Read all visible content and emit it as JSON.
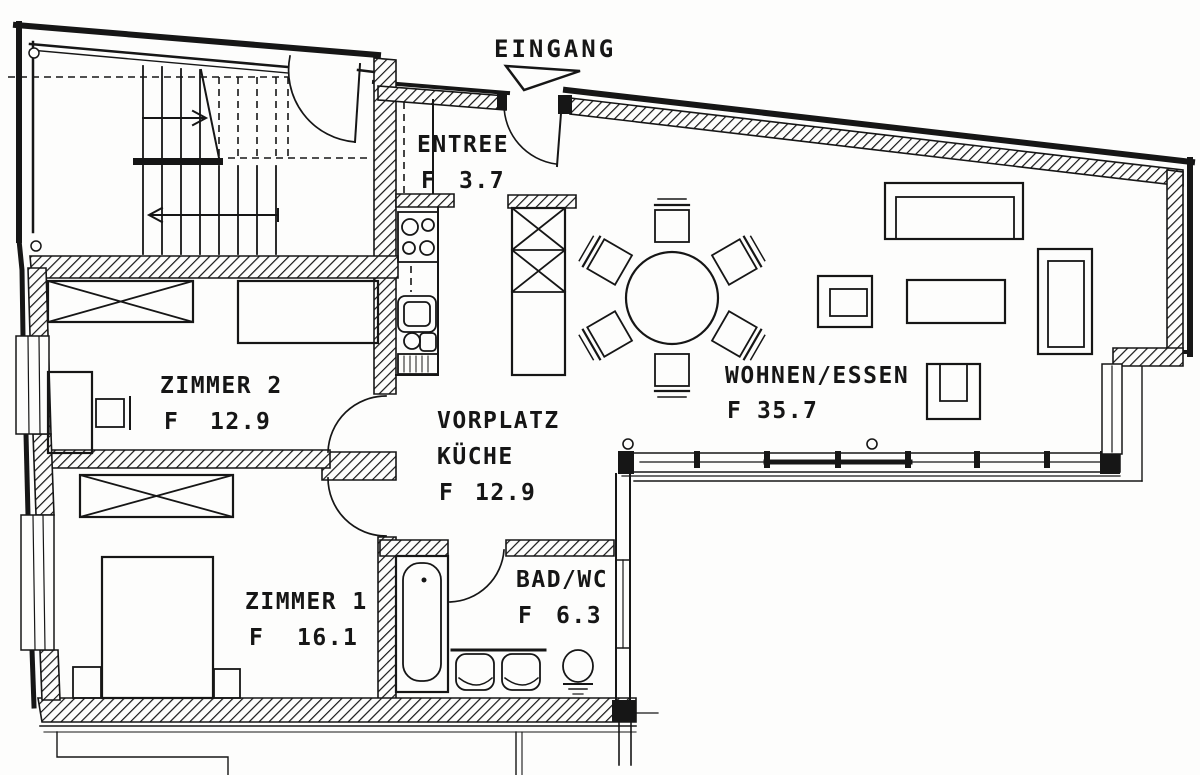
{
  "plan": {
    "entrance_label": "EINGANG",
    "rooms": {
      "entree": {
        "name": "ENTREE",
        "area_prefix": "F",
        "area": "3.7"
      },
      "vorplatz_kueche": {
        "name_line1": "VORPLATZ",
        "name_line2": "KÜCHE",
        "area_prefix": "F",
        "area": "12.9"
      },
      "zimmer2": {
        "name": "ZIMMER 2",
        "area_prefix": "F",
        "area": "12.9"
      },
      "zimmer1": {
        "name": "ZIMMER 1",
        "area_prefix": "F",
        "area": "16.1"
      },
      "wohnen_essen": {
        "name": "WOHNEN/ESSEN",
        "area_prefix": "F",
        "area": "35.7"
      },
      "bad_wc": {
        "name": "BAD/WC",
        "area_prefix": "F",
        "area": "6.3"
      }
    },
    "colors": {
      "ink": "#161616",
      "paper": "#fdfdfc"
    }
  }
}
